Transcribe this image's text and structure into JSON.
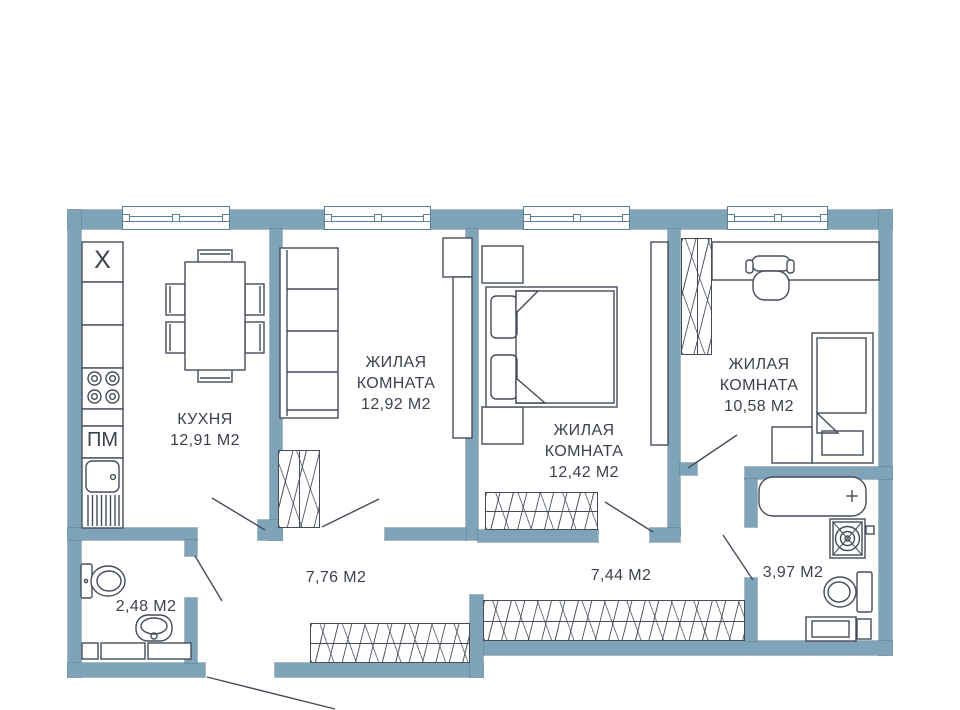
{
  "plan": {
    "colors": {
      "wall": "#7fa4b9",
      "wallline": "#5d7f94",
      "line": "#454c58",
      "text": "#3c424d",
      "bg": "#ffffff"
    },
    "rooms": [
      {
        "id": "kitchen",
        "name": "КУХНЯ",
        "area": "12,91 М2"
      },
      {
        "id": "living-room-1",
        "name": "ЖИЛАЯ КОМНАТА",
        "area": "12,92 М2"
      },
      {
        "id": "living-room-2",
        "name": "ЖИЛАЯ КОМНАТА",
        "area": "12,42 М2"
      },
      {
        "id": "living-room-3",
        "name": "ЖИЛАЯ КОМНАТА",
        "area": "10,58 М2"
      },
      {
        "id": "hallway-1",
        "area": "7,76 М2"
      },
      {
        "id": "hallway-2",
        "area": "7,44 М2"
      },
      {
        "id": "bathroom",
        "area": "3,97 М2"
      },
      {
        "id": "wc",
        "area": "2,48 М2"
      }
    ],
    "appliances": {
      "fridge_label": "X",
      "dishwasher_label": "ПМ"
    }
  }
}
